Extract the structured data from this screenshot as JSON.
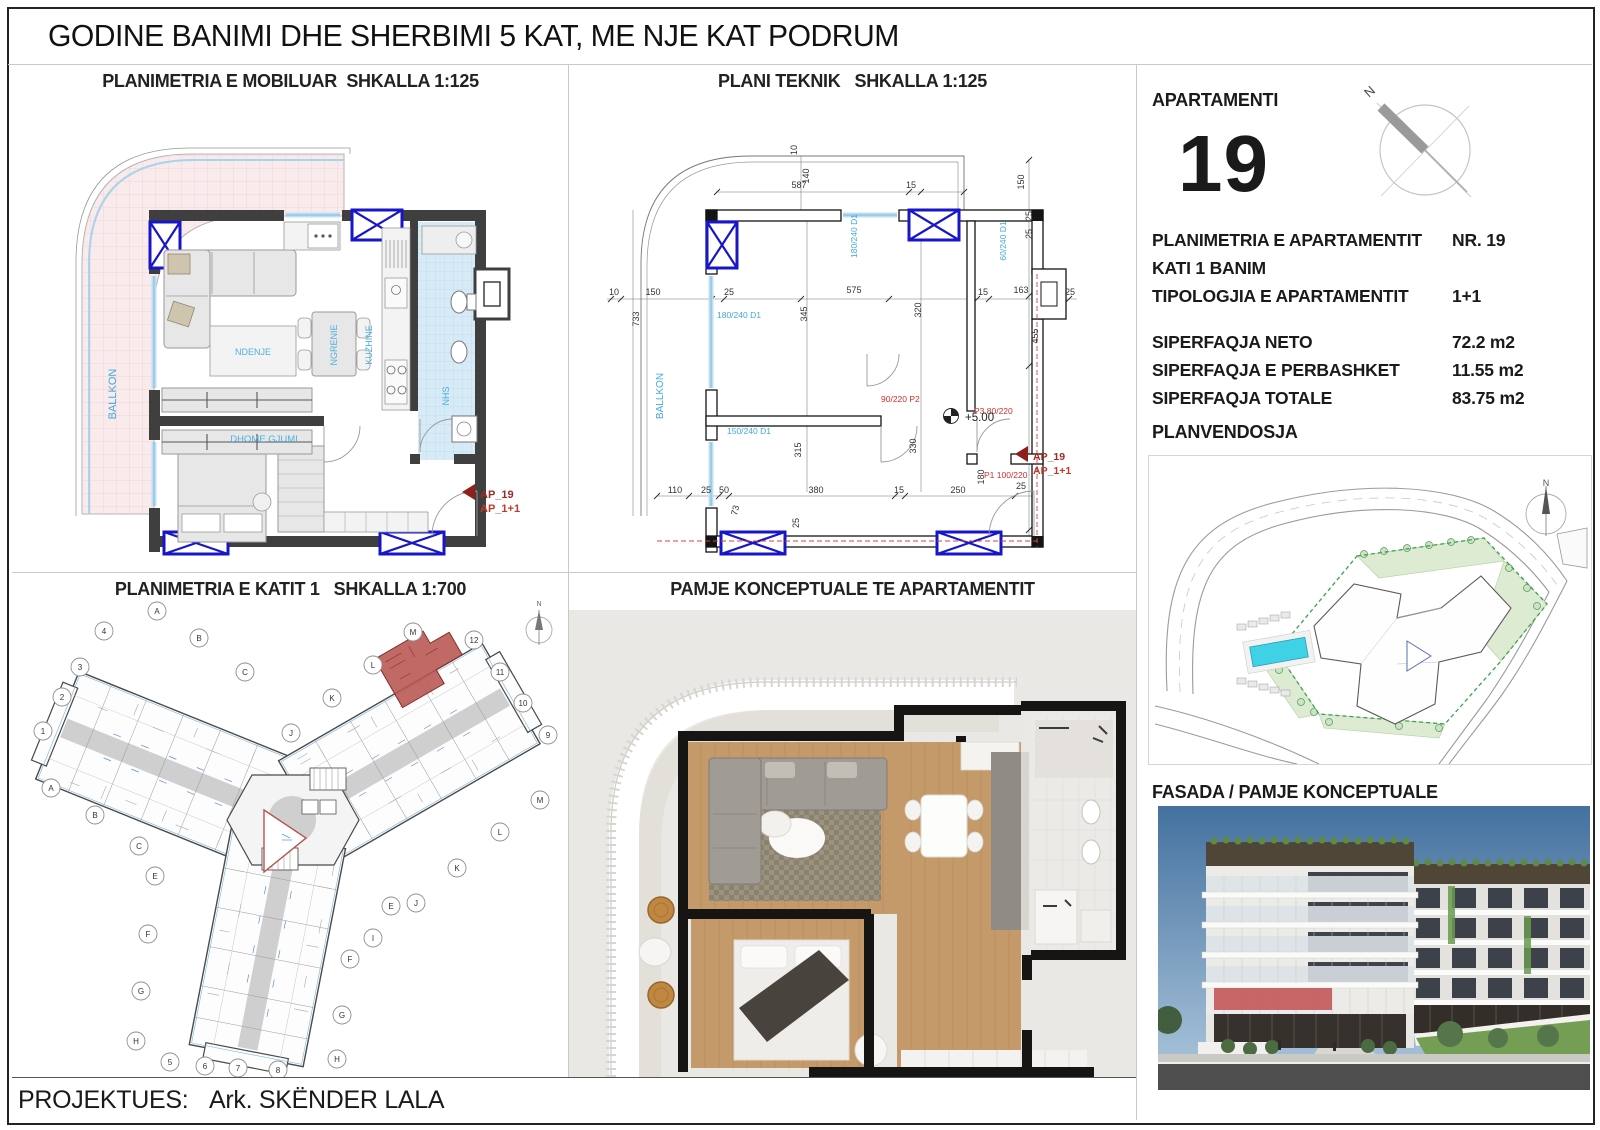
{
  "sheet": {
    "title": "GODINE BANIMI DHE SHERBIMI 5 KAT, ME NJE KAT PODRUM",
    "footer": {
      "label": "PROJEKTUES:",
      "value": "Ark. SKËNDER LALA"
    }
  },
  "quadrants": {
    "furnished": {
      "title": "PLANIMETRIA E MOBILUAR  SHKALLA 1:125",
      "labels": [
        {
          "t": "BALLKON",
          "x": 104,
          "y": 330,
          "rot": -90,
          "c": "#3fa8dc",
          "s": 11,
          "anchor": "middle",
          "name": "room-label-ballkon"
        },
        {
          "t": "NDENJE",
          "x": 241,
          "y": 291,
          "c": "#4fb0de",
          "s": 9,
          "anchor": "middle",
          "name": "room-label-ndenje"
        },
        {
          "t": "NGRENIE",
          "x": 325,
          "y": 281,
          "rot": -90,
          "c": "#4fb0de",
          "s": 9,
          "anchor": "middle",
          "name": "room-label-ngrenie"
        },
        {
          "t": "KUZHINE",
          "x": 360,
          "y": 281,
          "rot": -90,
          "c": "#4fb0de",
          "s": 9,
          "anchor": "middle",
          "name": "room-label-kuzhine"
        },
        {
          "t": "DHOME GJUMI",
          "x": 252,
          "y": 378,
          "c": "#4fb0de",
          "s": 9.5,
          "anchor": "middle",
          "name": "room-label-dhome-gjumi"
        },
        {
          "t": "NHS",
          "x": 437,
          "y": 332,
          "rot": -90,
          "c": "#4fb0de",
          "s": 9,
          "anchor": "middle",
          "name": "room-label-nhs"
        },
        {
          "t": "AP_19",
          "x": 468,
          "y": 434,
          "c": "#9e2b25",
          "s": 11,
          "w": "bold",
          "name": "apartment-marker-id"
        },
        {
          "t": "AP_1+1",
          "x": 468,
          "y": 448,
          "c": "#c0392b",
          "s": 11,
          "w": "bold",
          "name": "apartment-marker-type"
        }
      ]
    },
    "technical": {
      "title": "PLANI TEKNIK   SHKALLA 1:125",
      "labels": [
        {
          "t": "587",
          "x": 230,
          "y": 124,
          "anchor": "middle",
          "name": "dim"
        },
        {
          "t": "140",
          "x": 240,
          "y": 112,
          "rot": -90,
          "anchor": "middle",
          "name": "dim"
        },
        {
          "t": "10",
          "x": 228,
          "y": 86,
          "rot": -90,
          "anchor": "middle",
          "name": "dim"
        },
        {
          "t": "15",
          "x": 342,
          "y": 124,
          "anchor": "middle",
          "name": "dim"
        },
        {
          "t": "150",
          "x": 455,
          "y": 118,
          "rot": -90,
          "anchor": "middle",
          "name": "dim"
        },
        {
          "t": "10",
          "x": 45,
          "y": 231,
          "anchor": "middle",
          "name": "dim"
        },
        {
          "t": "150",
          "x": 84,
          "y": 231,
          "anchor": "middle",
          "name": "dim"
        },
        {
          "t": "733",
          "x": 70,
          "y": 255,
          "rot": -90,
          "anchor": "middle",
          "name": "dim"
        },
        {
          "t": "25",
          "x": 160,
          "y": 231,
          "anchor": "middle",
          "name": "dim"
        },
        {
          "t": "345",
          "x": 238,
          "y": 250,
          "rot": -90,
          "anchor": "middle",
          "name": "dim"
        },
        {
          "t": "575",
          "x": 285,
          "y": 229,
          "anchor": "middle",
          "name": "dim"
        },
        {
          "t": "320",
          "x": 352,
          "y": 246,
          "rot": -90,
          "anchor": "middle",
          "name": "dim"
        },
        {
          "t": "15",
          "x": 414,
          "y": 231,
          "anchor": "middle",
          "name": "dim"
        },
        {
          "t": "163",
          "x": 452,
          "y": 229,
          "anchor": "middle",
          "name": "dim"
        },
        {
          "t": "25",
          "x": 501,
          "y": 231,
          "anchor": "middle",
          "name": "dim"
        },
        {
          "t": "25",
          "x": 463,
          "y": 152,
          "rot": -90,
          "anchor": "middle",
          "name": "dim"
        },
        {
          "t": "25",
          "x": 463,
          "y": 170,
          "rot": -90,
          "anchor": "middle",
          "name": "dim"
        },
        {
          "t": "455",
          "x": 469,
          "y": 272,
          "rot": -90,
          "anchor": "middle",
          "name": "dim"
        },
        {
          "t": "315",
          "x": 232,
          "y": 386,
          "rot": -90,
          "anchor": "middle",
          "name": "dim"
        },
        {
          "t": "330",
          "x": 347,
          "y": 382,
          "rot": -90,
          "anchor": "middle",
          "name": "dim"
        },
        {
          "t": "180",
          "x": 415,
          "y": 413,
          "rot": -90,
          "anchor": "middle",
          "name": "dim"
        },
        {
          "t": "110",
          "x": 106,
          "y": 429,
          "anchor": "middle",
          "name": "dim"
        },
        {
          "t": "25",
          "x": 137,
          "y": 429,
          "anchor": "middle",
          "name": "dim"
        },
        {
          "t": "50",
          "x": 155,
          "y": 429,
          "anchor": "middle",
          "name": "dim"
        },
        {
          "t": "73",
          "x": 169,
          "y": 447,
          "rot": -75,
          "anchor": "middle",
          "name": "dim"
        },
        {
          "t": "380",
          "x": 247,
          "y": 429,
          "anchor": "middle",
          "name": "dim"
        },
        {
          "t": "15",
          "x": 330,
          "y": 429,
          "anchor": "middle",
          "name": "dim"
        },
        {
          "t": "250",
          "x": 389,
          "y": 429,
          "anchor": "middle",
          "name": "dim"
        },
        {
          "t": "25",
          "x": 452,
          "y": 425,
          "anchor": "middle",
          "name": "dim"
        },
        {
          "t": "25",
          "x": 230,
          "y": 459,
          "rot": -90,
          "anchor": "middle",
          "name": "dim"
        },
        {
          "t": "180/240 D1",
          "x": 288,
          "y": 172,
          "rot": -90,
          "c": "#3fa8dc",
          "s": 8.5,
          "anchor": "middle",
          "name": "window-label"
        },
        {
          "t": "60/240 D1",
          "x": 437,
          "y": 177,
          "rot": -90,
          "c": "#3fa8dc",
          "s": 8.5,
          "anchor": "middle",
          "name": "window-label"
        },
        {
          "t": "180/240 D1",
          "x": 148,
          "y": 254,
          "c": "#3fa8dc",
          "s": 8.5,
          "name": "window-label"
        },
        {
          "t": "150/240 D1",
          "x": 158,
          "y": 370,
          "c": "#3fa8dc",
          "s": 8.5,
          "name": "window-label"
        },
        {
          "t": "BALLKON",
          "x": 94,
          "y": 332,
          "rot": -90,
          "c": "#3fa8dc",
          "s": 10,
          "anchor": "middle",
          "name": "room-label-ballkon"
        },
        {
          "t": "90/220 P2",
          "x": 312,
          "y": 338,
          "c": "#cc2e2e",
          "s": 8.5,
          "name": "door-label"
        },
        {
          "t": "P3 80/220",
          "x": 405,
          "y": 350,
          "c": "#cc2e2e",
          "s": 8.5,
          "name": "door-label"
        },
        {
          "t": "P1 100/220",
          "x": 415,
          "y": 414,
          "c": "#cc2e2e",
          "s": 8.5,
          "name": "door-label"
        },
        {
          "t": "+5.00",
          "x": 396,
          "y": 357,
          "s": 11.5,
          "c": "#222",
          "name": "level-label"
        },
        {
          "t": "AP_19",
          "x": 464,
          "y": 396,
          "c": "#9e2b25",
          "s": 10.5,
          "w": "bold",
          "name": "apartment-marker-id"
        },
        {
          "t": "AP_1+1",
          "x": 464,
          "y": 410,
          "c": "#c0392b",
          "s": 10.5,
          "w": "bold",
          "name": "apartment-marker-type"
        }
      ]
    },
    "floor1": {
      "title": "PLANIMETRIA E KATIT 1   SHKALLA 1:700",
      "bubbles": [
        {
          "t": "4",
          "x": 92,
          "y": 59
        },
        {
          "t": "A",
          "x": 145,
          "y": 39
        },
        {
          "t": "3",
          "x": 68,
          "y": 95
        },
        {
          "t": "B",
          "x": 187,
          "y": 66
        },
        {
          "t": "2",
          "x": 50,
          "y": 125
        },
        {
          "t": "C",
          "x": 233,
          "y": 100
        },
        {
          "t": "1",
          "x": 31,
          "y": 159
        },
        {
          "t": "M",
          "x": 401,
          "y": 60
        },
        {
          "t": "12",
          "x": 462,
          "y": 68
        },
        {
          "t": "L",
          "x": 361,
          "y": 93
        },
        {
          "t": "11",
          "x": 488,
          "y": 100
        },
        {
          "t": "K",
          "x": 320,
          "y": 126
        },
        {
          "t": "10",
          "x": 511,
          "y": 131
        },
        {
          "t": "9",
          "x": 536,
          "y": 163
        },
        {
          "t": "J",
          "x": 279,
          "y": 161
        },
        {
          "t": "A",
          "x": 39,
          "y": 216
        },
        {
          "t": "B",
          "x": 83,
          "y": 243
        },
        {
          "t": "C",
          "x": 127,
          "y": 274
        },
        {
          "t": "M",
          "x": 528,
          "y": 228
        },
        {
          "t": "L",
          "x": 488,
          "y": 260
        },
        {
          "t": "K",
          "x": 445,
          "y": 296
        },
        {
          "t": "E",
          "x": 143,
          "y": 304
        },
        {
          "t": "J",
          "x": 404,
          "y": 331
        },
        {
          "t": "E",
          "x": 379,
          "y": 334
        },
        {
          "t": "I",
          "x": 361,
          "y": 366
        },
        {
          "t": "F",
          "x": 136,
          "y": 362
        },
        {
          "t": "F",
          "x": 338,
          "y": 387
        },
        {
          "t": "G",
          "x": 129,
          "y": 419
        },
        {
          "t": "G",
          "x": 330,
          "y": 443
        },
        {
          "t": "H",
          "x": 124,
          "y": 469
        },
        {
          "t": "H",
          "x": 325,
          "y": 487
        },
        {
          "t": "5",
          "x": 158,
          "y": 490
        },
        {
          "t": "6",
          "x": 193,
          "y": 494
        },
        {
          "t": "7",
          "x": 226,
          "y": 496
        },
        {
          "t": "8",
          "x": 266,
          "y": 498
        }
      ],
      "labels": [
        {
          "t": "N",
          "x": 527,
          "y": 34,
          "s": 7,
          "c": "#666",
          "anchor": "middle",
          "name": "north-label"
        }
      ]
    },
    "concept": {
      "title": "PAMJE KONCEPTUALE TE APARTAMENTIT"
    }
  },
  "sidebar": {
    "apartment_label": "APARTAMENTI",
    "apartment_number": "19",
    "compass_labels": [
      {
        "t": "N",
        "x": 18,
        "y": 24,
        "rot": -42,
        "s": 13,
        "c": "#4a4a4a",
        "name": "north-label"
      }
    ],
    "info_rows": [
      {
        "label": "PLANIMETRIA E APARTAMENTIT",
        "value": "NR. 19"
      },
      {
        "label": "KATI 1 BANIM",
        "value": ""
      },
      {
        "label": "TIPOLOGJIA E APARTAMENTIT",
        "value": "1+1"
      }
    ],
    "area_rows": [
      {
        "label": "SIPERFAQJA NETO",
        "value": "72.2 m2"
      },
      {
        "label": "SIPERFAQJA E PERBASHKET",
        "value": "11.55 m2"
      },
      {
        "label": "SIPERFAQJA TOTALE",
        "value": "83.75 m2"
      }
    ],
    "site_plan_label": "PLANVENDOSJA",
    "site_labels": [
      {
        "t": "N",
        "x": 397,
        "y": 30,
        "s": 9,
        "c": "#555",
        "anchor": "middle",
        "name": "north-label"
      }
    ],
    "facade_label": "FASADA / PAMJE KONCEPTUALE"
  },
  "colors": {
    "highlight_red": "#b85450",
    "window_blue": "#1717c9",
    "label_blue": "#3fa8dc",
    "door_red": "#cc2e2e",
    "balcony_pink": "#f9eaec",
    "bath_blue": "#d6ebf6",
    "pool_cyan": "#3fd2e6"
  }
}
